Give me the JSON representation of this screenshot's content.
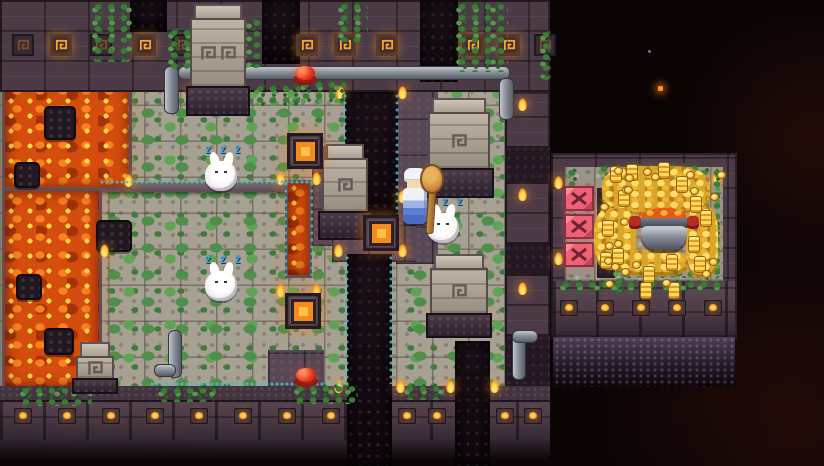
{
  "scene": {
    "zzz": "Z Z Z"
  },
  "palette": {
    "lava": "#d44d0e",
    "wall": "#4c3b47",
    "moss": "#4f8f4b",
    "rune_glow": "#ffa226",
    "zzz_blue": "#45a8e6",
    "gold": "#f3bd37",
    "barrier_pink": "#ef6276",
    "flame": "#ff9c22"
  },
  "terrain": [
    {
      "k": "floor",
      "n": "main-floor",
      "x": 0,
      "y": 78,
      "w": 550,
      "h": 316
    },
    {
      "k": "path",
      "n": "dark-path",
      "x": 396,
      "y": 88,
      "w": 42,
      "h": 176
    },
    {
      "k": "path",
      "n": "dark-path",
      "x": 312,
      "y": 146,
      "w": 34,
      "h": 100
    },
    {
      "k": "path",
      "n": "dark-path",
      "x": 332,
      "y": 204,
      "w": 84,
      "h": 58
    },
    {
      "k": "path",
      "n": "dark-path",
      "x": 268,
      "y": 350,
      "w": 56,
      "h": 40
    },
    {
      "k": "ledge",
      "n": "stone-ledge",
      "x": 98,
      "y": 182,
      "w": 214,
      "h": 10
    },
    {
      "k": "lava",
      "n": "lava-pool",
      "x": 2,
      "y": 78,
      "w": 130,
      "h": 112
    },
    {
      "k": "lava",
      "n": "lava-pool",
      "x": 2,
      "y": 188,
      "w": 100,
      "h": 202
    },
    {
      "k": "lava",
      "n": "lava-channel",
      "x": 285,
      "y": 180,
      "w": 27,
      "h": 98
    },
    {
      "k": "rock",
      "n": "lava-rock",
      "x": 44,
      "y": 106,
      "w": 32,
      "h": 34
    },
    {
      "k": "rock",
      "n": "lava-rock",
      "x": 14,
      "y": 162,
      "w": 26,
      "h": 26
    },
    {
      "k": "rock",
      "n": "lava-rock",
      "x": 16,
      "y": 274,
      "w": 26,
      "h": 26
    },
    {
      "k": "rock",
      "n": "lava-rock",
      "x": 44,
      "y": 328,
      "w": 30,
      "h": 27
    },
    {
      "k": "rock",
      "n": "stone-block",
      "x": 96,
      "y": 220,
      "w": 36,
      "h": 32
    },
    {
      "k": "wall",
      "n": "top-wall",
      "x": 0,
      "y": 0,
      "w": 550,
      "h": 92
    },
    {
      "k": "wallb",
      "n": "bottom-wall",
      "x": 0,
      "y": 386,
      "w": 550,
      "h": 56
    },
    {
      "k": "wledge",
      "n": "bottom-wall-ledge",
      "x": 0,
      "y": 386,
      "w": 550,
      "h": 16
    },
    {
      "k": "fade",
      "n": "bottom-fade",
      "x": 0,
      "y": 440,
      "w": 550,
      "h": 26
    },
    {
      "k": "dstrip",
      "n": "east-shadow",
      "x": 505,
      "y": 92,
      "w": 45,
      "h": 294
    },
    {
      "k": "wall",
      "n": "east-wall-block",
      "x": 505,
      "y": 92,
      "w": 45,
      "h": 56
    },
    {
      "k": "wall",
      "n": "east-wall-block",
      "x": 505,
      "y": 182,
      "w": 45,
      "h": 62
    },
    {
      "k": "wall",
      "n": "east-wall-block",
      "x": 505,
      "y": 274,
      "w": 45,
      "h": 62
    },
    {
      "k": "pit",
      "n": "doorway-north",
      "x": 130,
      "y": 0,
      "w": 37,
      "h": 32
    },
    {
      "k": "pit",
      "n": "doorway-north",
      "x": 262,
      "y": 0,
      "w": 38,
      "h": 64
    },
    {
      "k": "pit",
      "n": "doorway-north",
      "x": 420,
      "y": 0,
      "w": 38,
      "h": 82
    },
    {
      "k": "pit",
      "n": "chasm",
      "x": 345,
      "y": 92,
      "w": 53,
      "h": 124
    },
    {
      "k": "pit",
      "n": "chasm",
      "x": 347,
      "y": 254,
      "w": 45,
      "h": 212
    },
    {
      "k": "pit",
      "n": "doorway-south",
      "x": 455,
      "y": 341,
      "w": 35,
      "h": 125
    },
    {
      "k": "wall",
      "n": "treasure-room-wall",
      "x": 551,
      "y": 153,
      "w": 186,
      "h": 186
    },
    {
      "k": "fadep",
      "n": "treasure-fade",
      "x": 553,
      "y": 337,
      "w": 182,
      "h": 50
    },
    {
      "k": "floorg",
      "n": "treasure-floor",
      "x": 565,
      "y": 167,
      "w": 158,
      "h": 114
    },
    {
      "k": "wallb",
      "n": "treasure-bottom-wall",
      "x": 553,
      "y": 281,
      "w": 182,
      "h": 56
    },
    {
      "k": "dstrip",
      "n": "machinery",
      "x": 597,
      "y": 188,
      "w": 18,
      "h": 90
    }
  ],
  "pipes": [
    {
      "x": 178,
      "y": 66,
      "w": 332,
      "h": 14,
      "o": "h"
    },
    {
      "x": 164,
      "y": 66,
      "w": 15,
      "h": 48,
      "o": "v"
    },
    {
      "x": 499,
      "y": 78,
      "w": 15,
      "h": 42,
      "o": "v"
    },
    {
      "x": 168,
      "y": 330,
      "w": 14,
      "h": 48,
      "o": "v"
    },
    {
      "x": 154,
      "y": 364,
      "w": 22,
      "h": 13,
      "o": "h"
    },
    {
      "x": 512,
      "y": 334,
      "w": 14,
      "h": 46,
      "o": "v"
    },
    {
      "x": 512,
      "y": 330,
      "w": 26,
      "h": 13,
      "o": "h"
    }
  ],
  "runes": {
    "y": 34,
    "list": [
      {
        "x": 12,
        "b": 0
      },
      {
        "x": 50,
        "b": 1
      },
      {
        "x": 90,
        "b": 0
      },
      {
        "x": 134,
        "b": 1
      },
      {
        "x": 172,
        "b": 0
      },
      {
        "x": 296,
        "b": 1
      },
      {
        "x": 334,
        "b": 1
      },
      {
        "x": 376,
        "b": 1
      },
      {
        "x": 462,
        "b": 1
      },
      {
        "x": 498,
        "b": 1
      },
      {
        "x": 534,
        "b": 0
      }
    ]
  },
  "sconces_main": {
    "y": 408,
    "xs": [
      14,
      58,
      102,
      146,
      190,
      234,
      278,
      322,
      398,
      428,
      496,
      524
    ]
  },
  "sconces_treasure": {
    "y": 300,
    "xs": [
      560,
      596,
      632,
      668,
      704
    ]
  },
  "flames": [
    [
      124,
      174
    ],
    [
      100,
      244
    ],
    [
      276,
      172
    ],
    [
      312,
      172
    ],
    [
      276,
      284
    ],
    [
      312,
      284
    ],
    [
      336,
      86
    ],
    [
      398,
      86
    ],
    [
      334,
      190
    ],
    [
      398,
      190
    ],
    [
      334,
      244
    ],
    [
      398,
      244
    ],
    [
      334,
      380
    ],
    [
      396,
      380
    ],
    [
      446,
      380
    ],
    [
      490,
      380
    ],
    [
      428,
      168
    ],
    [
      480,
      168
    ],
    [
      432,
      308
    ],
    [
      480,
      308
    ],
    [
      186,
      86
    ],
    [
      518,
      98
    ],
    [
      518,
      188
    ],
    [
      518,
      282
    ],
    [
      554,
      176
    ],
    [
      712,
      172
    ],
    [
      554,
      252
    ],
    [
      600,
      206
    ]
  ],
  "vines": [
    [
      92,
      2,
      40,
      60
    ],
    [
      168,
      28,
      30,
      44
    ],
    [
      212,
      18,
      50,
      50
    ],
    [
      338,
      2,
      30,
      40
    ],
    [
      300,
      80,
      46,
      24
    ],
    [
      254,
      84,
      46,
      22
    ],
    [
      456,
      2,
      52,
      70
    ],
    [
      540,
      30,
      12,
      50
    ],
    [
      20,
      386,
      72,
      20
    ],
    [
      158,
      386,
      58,
      16
    ],
    [
      294,
      384,
      64,
      20
    ],
    [
      404,
      384,
      40,
      16
    ],
    [
      613,
      188,
      14,
      104
    ],
    [
      698,
      168,
      22,
      112
    ],
    [
      598,
      164,
      104,
      16
    ],
    [
      620,
      258,
      80,
      20
    ],
    [
      560,
      280,
      84,
      14
    ],
    [
      646,
      280,
      78,
      12
    ],
    [
      566,
      168,
      12,
      60
    ]
  ],
  "edges": [
    [
      343,
      94,
      4,
      120
    ],
    [
      395,
      94,
      4,
      120
    ],
    [
      284,
      182,
      3,
      94
    ],
    [
      310,
      182,
      3,
      94
    ],
    [
      345,
      256,
      4,
      128
    ],
    [
      389,
      256,
      4,
      128
    ],
    [
      100,
      180,
      212,
      4
    ],
    [
      150,
      382,
      200,
      4
    ]
  ],
  "structures": {
    "tower": {
      "x": 186,
      "y": 4,
      "w": 64,
      "h": 112,
      "spirals": 2
    },
    "pillar": {
      "x": 318,
      "y": 144,
      "w": 54,
      "h": 96,
      "spirals": 1
    },
    "statues": [
      {
        "x": 424,
        "y": 98,
        "w": 70,
        "h": 100,
        "spirals": 1
      },
      {
        "x": 426,
        "y": 254,
        "w": 66,
        "h": 84,
        "spirals": 1
      }
    ],
    "lava_statue": {
      "x": 72,
      "y": 342,
      "w": 46,
      "h": 52,
      "spirals": 1
    }
  },
  "entities": {
    "buttons": [
      {
        "x": 292,
        "y": 64
      },
      {
        "x": 293,
        "y": 366
      }
    ],
    "plates": [
      {
        "x": 363,
        "y": 215
      },
      {
        "x": 285,
        "y": 293
      },
      {
        "x": 287,
        "y": 133
      }
    ],
    "xblocks": [
      {
        "x": 564,
        "y": 186
      },
      {
        "x": 564,
        "y": 214
      },
      {
        "x": 564,
        "y": 242
      }
    ],
    "rabbits": [
      {
        "x": 204,
        "y": 146
      },
      {
        "x": 204,
        "y": 256
      },
      {
        "x": 426,
        "y": 198
      }
    ],
    "player": {
      "x": 398,
      "y": 164
    },
    "pot": {
      "x": 632,
      "y": 200
    },
    "mounds": [
      [
        602,
        166,
        108,
        50
      ],
      [
        594,
        208,
        42,
        62
      ],
      [
        686,
        206,
        32,
        72
      ],
      [
        618,
        250,
        70,
        26
      ]
    ],
    "stacks": [
      [
        676,
        176
      ],
      [
        690,
        196
      ],
      [
        618,
        190
      ],
      [
        602,
        220
      ],
      [
        612,
        248
      ],
      [
        666,
        254
      ],
      [
        688,
        236
      ],
      [
        643,
        266
      ],
      [
        700,
        210
      ],
      [
        626,
        164
      ],
      [
        658,
        162
      ],
      [
        610,
        166
      ],
      [
        694,
        256
      ],
      [
        640,
        282
      ],
      [
        668,
        282
      ],
      [
        600,
        252
      ]
    ],
    "coins": {
      "count": 40,
      "x": 596,
      "y": 164,
      "w": 122,
      "h": 116
    },
    "ember": {
      "x": 658,
      "y": 86
    },
    "spark": {
      "x": 648,
      "y": 50
    }
  }
}
